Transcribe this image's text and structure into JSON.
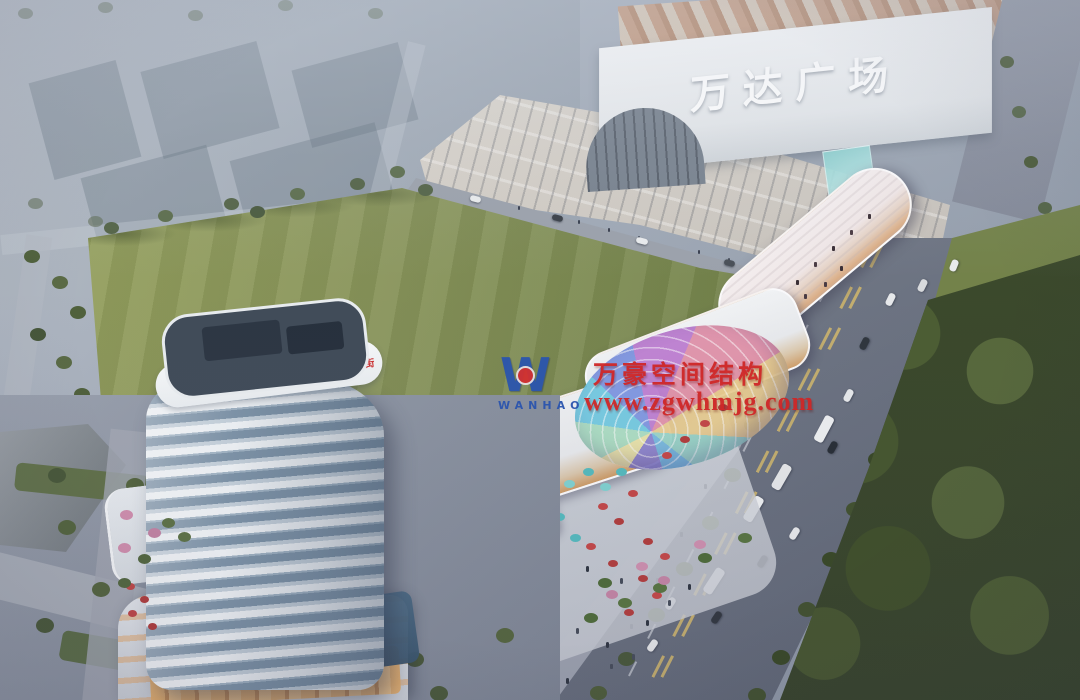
{
  "mall": {
    "sign": "万达广场"
  },
  "tower": {
    "sign": "恒汇·天街"
  },
  "watermark": {
    "logo_letter": "W",
    "logo_subtext": "WANHAO",
    "brand": "万豪空间结构",
    "url": "www.zgwhmjg.com"
  },
  "palette": {
    "watermark_red": "#cf2727",
    "watermark_blue": "#2b55ae",
    "field_green": "#87935a",
    "tree_dark": "#42512f",
    "road_gray": "#6a7180",
    "facade_white": "#f2f3f4",
    "warm_glow": "#e9b26d",
    "canopy_colors": [
      "#f5eed0",
      "#ffd9a2",
      "#a6e3d3",
      "#6cc8e6",
      "#7f9ce8",
      "#d183c8",
      "#8f6fd0",
      "#4f6ec0"
    ]
  }
}
